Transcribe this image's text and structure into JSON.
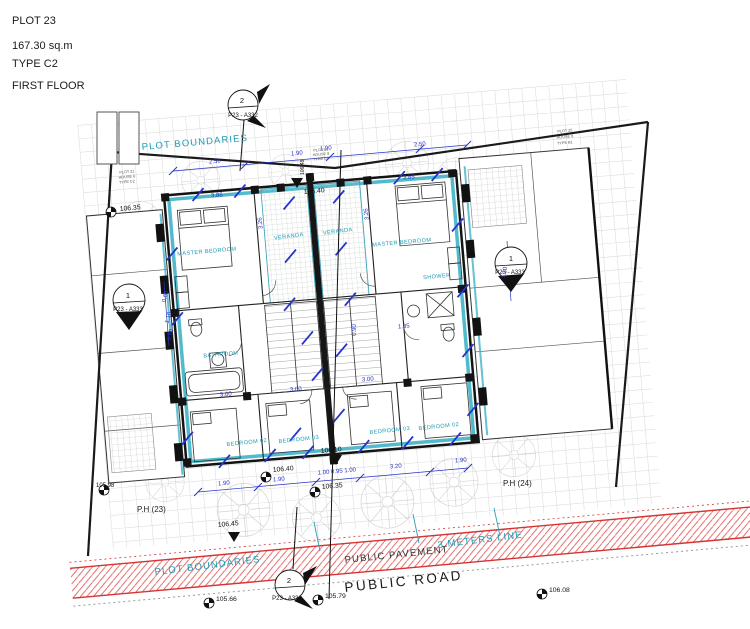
{
  "title": {
    "plot": "PLOT 23",
    "area": "167.30 sq.m",
    "type": "TYPE C2",
    "floor": "FIRST FLOOR"
  },
  "labels": {
    "plot_boundaries_top": "PLOT BOUNDARIES",
    "plot_boundaries_bottom": "PLOT BOUNDARIES",
    "public_pavement": "PUBLIC PAVEMENT",
    "meters_line": "3 METERS LINE",
    "public_road": "PUBLIC ROAD",
    "ph_left": "P.H (23)",
    "ph_right": "P.H (24)"
  },
  "rooms": {
    "master_left": "MASTER BEDROOM",
    "master_right": "MASTER BEDROOM",
    "veranda_left": "VERANDA",
    "veranda_right": "VERANDA",
    "bathroom": "BATHROOM",
    "shower": "SHOWER",
    "bedroom02_left": "BEDROOM 02",
    "bedroom03_left": "BEDROOM 03",
    "bedroom03_right": "BEDROOM 03",
    "bedroom02_right": "BEDROOM 02"
  },
  "markers": {
    "top": {
      "num": "2",
      "ref": "P23 - A332"
    },
    "bottom": {
      "num": "2",
      "ref": "P23 - A332"
    },
    "left": {
      "num": "1",
      "ref": "P23 - A333"
    },
    "right": {
      "num": "1",
      "ref": "P23 - A333"
    }
  },
  "levels": {
    "l10635_a": "106.35",
    "l10640_top": "106.40",
    "l10648": "106.48",
    "l10640_bottom": "106.40",
    "l10610": "106.10",
    "l10635_b": "106.35",
    "l10645": "106.45",
    "l10598": "105.98",
    "l10566": "105.66",
    "l10579": "105.79",
    "l10608": "106.08"
  },
  "dims": {
    "d250_a": "2.50",
    "d190_a": "1.90",
    "d190_b": "1.90",
    "d250_b": "2.50",
    "d386": "3.86",
    "d385": "3.85",
    "d326_l": "3.26",
    "d326_r": "3.26",
    "d060_a": "0.60",
    "d110_l": "1.10",
    "d060_b": "0.60",
    "d110_r": "1.10",
    "d300_a": "3.00",
    "d300_b": "3.00",
    "d300_c": "3.00",
    "d185": "1.85",
    "d090": "0.90",
    "dchain": "1.00 0.95 1.00",
    "d320": "3.20",
    "d190_c": "1.90",
    "d190_d": "1.90",
    "d190_e": "1.90"
  },
  "neighbors": {
    "left": [
      "PLOT 21",
      "HOUSE 6",
      "TYPE C2"
    ],
    "top": [
      "PLOT 22",
      "HOUSE 9",
      "TYPE C2"
    ],
    "right": [
      "PLOT 25",
      "HOUSE 8",
      "TYPE B1"
    ]
  },
  "colors": {
    "teal": "#1b9ab5",
    "cyan_wall": "#3fb3c8",
    "dim_blue": "#2733c8",
    "road_red": "#d63333"
  }
}
